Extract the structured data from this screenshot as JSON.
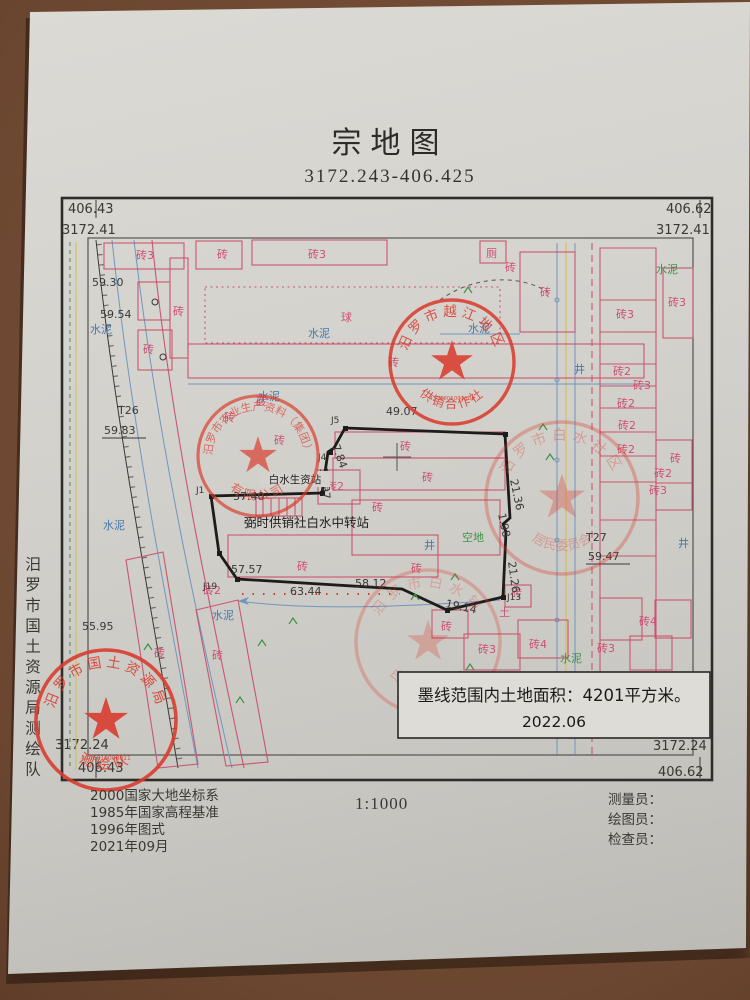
{
  "title": "宗地图",
  "subtitle": "3172.243-406.425",
  "side_note": "汨罗市国土资源局测绘队",
  "colors": {
    "stamp_red": "#da392b",
    "map_pink": "#c9566f",
    "map_blue": "#6f96c0",
    "map_green": "#3f9448",
    "paper": "#d4d2cd",
    "desk_brown": "#6b4630"
  },
  "frame": {
    "tl_e": "406.43",
    "tl_n": "3172.41",
    "tr_e": "406.62",
    "tr_n": "3172.41",
    "br_n": "3172.24",
    "br_e": "406.62",
    "bl_n": "3172.24",
    "bl_e": "406.43"
  },
  "area_box": {
    "line1": "墨线范围内土地面积：4201平方米。",
    "line2": "2022.06"
  },
  "footer": {
    "datum_lines": [
      "2000国家大地坐标系",
      "1985年国家高程基准",
      "1996年图式",
      "2021年09月"
    ],
    "scale": "1:1000",
    "staff": [
      "测量员：",
      "绘图员：",
      "检查员："
    ]
  },
  "stamps": {
    "coop": {
      "top": "汨罗市越江地区",
      "bottom": "供销合作社",
      "serial": "4306001003108"
    },
    "agri": {
      "top": "汨罗市农业生产资料（集团）",
      "bottom": "有限公司"
    },
    "community": {
      "top": "汨罗市白水社区",
      "bottom": "居民委员会"
    },
    "village": {
      "top": "汨罗市白水镇",
      "bottom": "白水村民委员会"
    },
    "survey": {
      "top": "汨罗市国土资源局",
      "bottom": "测绘队",
      "serial": "4306810008011"
    }
  },
  "map_labels": {
    "brick": "砖",
    "brick2": "砖2",
    "brick3": "砖3",
    "brick4": "砖4",
    "cement": "水泥",
    "ball_field": "球",
    "open_land": "空地",
    "toilet": "厕",
    "soil": "土",
    "well": "井",
    "station": "白水生资站",
    "transfer_station": "弼时供销社白水中转站",
    "elev_5930": "59.30",
    "elev_5954": "59.54",
    "elev_5983": "59.83",
    "elev_5947": "59.47",
    "elev_5595": "55.95",
    "t26": "T26",
    "t27": "T27",
    "len_4907": "49.07",
    "len_3740": "37.40",
    "len_5757": "57.57",
    "len_5812": "58.12",
    "len_6344": "63.44",
    "len_1914": "19.14",
    "len_2136": "21.36",
    "len_2126": "21.26",
    "len_1097": "10.97",
    "len_784": "7.84",
    "len_198": "1.98",
    "j1": "J1",
    "j4": "J4",
    "j5": "J5",
    "j13": "J13",
    "j19": "J19"
  }
}
